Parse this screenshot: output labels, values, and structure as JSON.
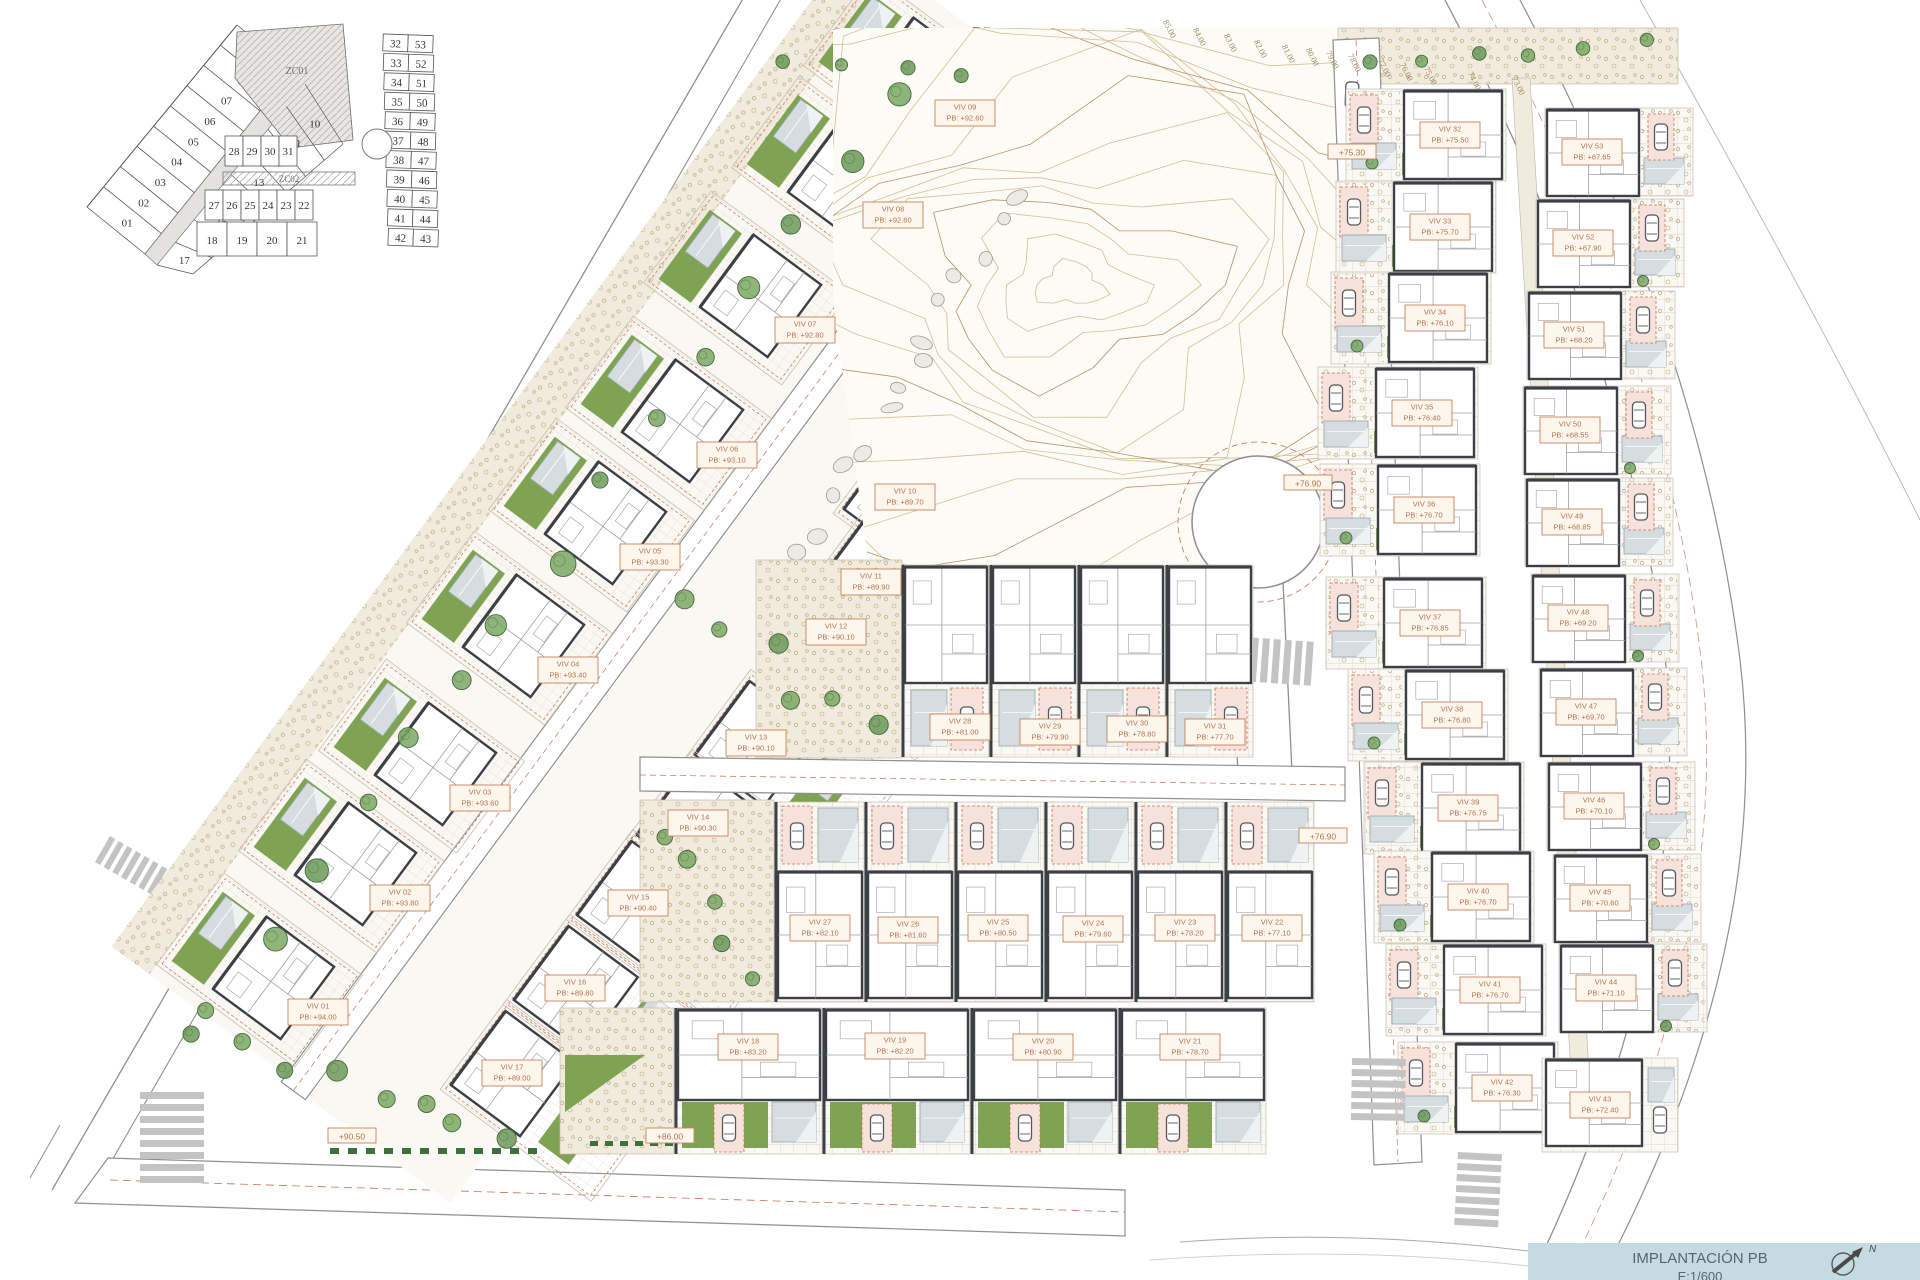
{
  "title_block": {
    "title": "IMPLANTACIÓN PB",
    "scale": "E:1/600",
    "north_label": "N"
  },
  "key_plan": {
    "zones": [
      "ZC01",
      "ZC02"
    ],
    "outer_lots": [
      "01",
      "02",
      "03",
      "04",
      "05",
      "06",
      "07",
      "08",
      "09"
    ],
    "inner_lots": [
      "10",
      "11",
      "12",
      "13",
      "14",
      "15",
      "16",
      "17"
    ],
    "row_a": [
      "28",
      "29",
      "30",
      "31"
    ],
    "row_b": [
      "27",
      "26",
      "25",
      "24",
      "23",
      "22"
    ],
    "row_c": [
      "18",
      "19",
      "20",
      "21"
    ],
    "right_block_left": [
      "32",
      "33",
      "34",
      "35",
      "36",
      "37",
      "38",
      "39",
      "40",
      "41",
      "42"
    ],
    "right_block_right": [
      "53",
      "52",
      "51",
      "50",
      "49",
      "48",
      "47",
      "46",
      "45",
      "44",
      "43"
    ]
  },
  "contour_labels": [
    {
      "text": "85.00",
      "x": 1167,
      "y": 30
    },
    {
      "text": "84.00",
      "x": 1197,
      "y": 38
    },
    {
      "text": "83.00",
      "x": 1228,
      "y": 44
    },
    {
      "text": "82.00",
      "x": 1258,
      "y": 50
    },
    {
      "text": "81.00",
      "x": 1286,
      "y": 55
    },
    {
      "text": "80.00",
      "x": 1310,
      "y": 58
    },
    {
      "text": "79.00",
      "x": 1330,
      "y": 61
    },
    {
      "text": "78.00",
      "x": 1352,
      "y": 64
    },
    {
      "text": "77.00",
      "x": 1382,
      "y": 69
    },
    {
      "text": "76.00",
      "x": 1404,
      "y": 73
    },
    {
      "text": "75.00",
      "x": 1428,
      "y": 77
    },
    {
      "text": "74.00",
      "x": 1472,
      "y": 82
    },
    {
      "text": "73.00",
      "x": 1516,
      "y": 87
    }
  ],
  "road_levels": [
    {
      "text": "+75.30",
      "x": 1352,
      "y": 152
    },
    {
      "text": "+76.90",
      "x": 1308,
      "y": 483
    },
    {
      "text": "+76.90",
      "x": 1323,
      "y": 836
    },
    {
      "text": "+86.00",
      "x": 670,
      "y": 1136
    },
    {
      "text": "+90.50",
      "x": 352,
      "y": 1136
    }
  ],
  "villas": [
    {
      "id": "VIV 01",
      "pb": "PB: +94.00",
      "x": 318,
      "y": 1012,
      "band": "outer",
      "i": 0
    },
    {
      "id": "VIV 02",
      "pb": "PB: +93.80",
      "x": 400,
      "y": 898,
      "band": "outer",
      "i": 1
    },
    {
      "id": "VIV 03",
      "pb": "PB: +93.60",
      "x": 480,
      "y": 798,
      "band": "outer",
      "i": 2
    },
    {
      "id": "VIV 04",
      "pb": "PB: +93.40",
      "x": 568,
      "y": 670,
      "band": "outer",
      "i": 3
    },
    {
      "id": "VIV 05",
      "pb": "PB: +93.30",
      "x": 650,
      "y": 557,
      "band": "outer",
      "i": 4
    },
    {
      "id": "VIV 06",
      "pb": "PB: +93.10",
      "x": 727,
      "y": 455,
      "band": "outer",
      "i": 5
    },
    {
      "id": "VIV 07",
      "pb": "PB: +92.80",
      "x": 805,
      "y": 330,
      "band": "outer",
      "i": 6
    },
    {
      "id": "VIV 08",
      "pb": "PB: +92.60",
      "x": 893,
      "y": 215,
      "band": "outer",
      "i": 7
    },
    {
      "id": "VIV 09",
      "pb": "PB: +92.60",
      "x": 965,
      "y": 113,
      "band": "outer",
      "i": 8
    },
    {
      "id": "VIV 10",
      "pb": "PB: +89.70",
      "x": 905,
      "y": 497,
      "band": "inner",
      "i": 0
    },
    {
      "id": "VIV 11",
      "pb": "PB: +89.90",
      "x": 871,
      "y": 582,
      "band": "inner",
      "i": 1
    },
    {
      "id": "VIV 12",
      "pb": "PB: +90.10",
      "x": 836,
      "y": 632,
      "band": "inner",
      "i": 2
    },
    {
      "id": "VIV 13",
      "pb": "PB: +90.10",
      "x": 756,
      "y": 743,
      "band": "inner",
      "i": 3
    },
    {
      "id": "VIV 14",
      "pb": "PB: +90.30",
      "x": 698,
      "y": 823,
      "band": "inner",
      "i": 4
    },
    {
      "id": "VIV 15",
      "pb": "PB: +90.40",
      "x": 638,
      "y": 903,
      "band": "inner",
      "i": 5
    },
    {
      "id": "VIV 16",
      "pb": "PB: +89.80",
      "x": 575,
      "y": 988,
      "band": "inner",
      "i": 6
    },
    {
      "id": "VIV 17",
      "pb": "PB: +89.00",
      "x": 512,
      "y": 1073,
      "band": "inner",
      "i": 7
    },
    {
      "id": "VIV 18",
      "pb": "PB: +83.20",
      "x": 748,
      "y": 1047,
      "band": "rowBig",
      "i": 0
    },
    {
      "id": "VIV 19",
      "pb": "PB: +82.20",
      "x": 895,
      "y": 1046,
      "band": "rowBig",
      "i": 1
    },
    {
      "id": "VIV 20",
      "pb": "PB: +80.90",
      "x": 1043,
      "y": 1047,
      "band": "rowBig",
      "i": 2
    },
    {
      "id": "VIV 21",
      "pb": "PB: +78.70",
      "x": 1190,
      "y": 1047,
      "band": "rowBig",
      "i": 3
    },
    {
      "id": "VIV 22",
      "pb": "PB: +77.10",
      "x": 1272,
      "y": 928,
      "band": "rowMid",
      "i": 5
    },
    {
      "id": "VIV 23",
      "pb": "PB: +78.20",
      "x": 1185,
      "y": 928,
      "band": "rowMid",
      "i": 4
    },
    {
      "id": "VIV 24",
      "pb": "PB: +79.60",
      "x": 1093,
      "y": 929,
      "band": "rowMid",
      "i": 3
    },
    {
      "id": "VIV 25",
      "pb": "PB: +80.50",
      "x": 998,
      "y": 928,
      "band": "rowMid",
      "i": 2
    },
    {
      "id": "VIV 26",
      "pb": "PB: +81.60",
      "x": 908,
      "y": 930,
      "band": "rowMid",
      "i": 1
    },
    {
      "id": "VIV 27",
      "pb": "PB: +82.10",
      "x": 820,
      "y": 928,
      "band": "rowMid",
      "i": 0
    },
    {
      "id": "VIV 28",
      "pb": "PB: +81.00",
      "x": 960,
      "y": 727,
      "band": "rowTop",
      "i": 0
    },
    {
      "id": "VIV 29",
      "pb": "PB: +79.90",
      "x": 1050,
      "y": 732,
      "band": "rowTop",
      "i": 1
    },
    {
      "id": "VIV 30",
      "pb": "PB: +78.80",
      "x": 1137,
      "y": 729,
      "band": "rowTop",
      "i": 2
    },
    {
      "id": "VIV 31",
      "pb": "PB: +77.70",
      "x": 1215,
      "y": 732,
      "band": "rowTop",
      "i": 3
    },
    {
      "id": "VIV 32",
      "pb": "PB: +75.50",
      "x": 1450,
      "y": 135,
      "band": "rcLeft",
      "i": 0
    },
    {
      "id": "VIV 33",
      "pb": "PB: +75.70",
      "x": 1440,
      "y": 227,
      "band": "rcLeft",
      "i": 1
    },
    {
      "id": "VIV 34",
      "pb": "PB: +76.10",
      "x": 1435,
      "y": 318,
      "band": "rcLeft",
      "i": 2
    },
    {
      "id": "VIV 35",
      "pb": "PB: +76.40",
      "x": 1422,
      "y": 413,
      "band": "rcLeft",
      "i": 3
    },
    {
      "id": "VIV 36",
      "pb": "PB: +76.70",
      "x": 1424,
      "y": 510,
      "band": "rcLeft",
      "i": 4
    },
    {
      "id": "VIV 37",
      "pb": "PB: +76.85",
      "x": 1430,
      "y": 623,
      "band": "rcLeft",
      "i": 5
    },
    {
      "id": "VIV 38",
      "pb": "PB: +76.80",
      "x": 1452,
      "y": 715,
      "band": "rcLeft",
      "i": 6
    },
    {
      "id": "VIV 39",
      "pb": "PB: +76.75",
      "x": 1468,
      "y": 808,
      "band": "rcLeft",
      "i": 7
    },
    {
      "id": "VIV 40",
      "pb": "PB: +76.70",
      "x": 1478,
      "y": 897,
      "band": "rcLeft",
      "i": 8
    },
    {
      "id": "VIV 41",
      "pb": "PB: +76.70",
      "x": 1490,
      "y": 990,
      "band": "rcLeft",
      "i": 9
    },
    {
      "id": "VIV 42",
      "pb": "PB: +76.30",
      "x": 1502,
      "y": 1088,
      "band": "rcLeft",
      "i": 10
    },
    {
      "id": "VIV 43",
      "pb": "PB: +72.40",
      "x": 1600,
      "y": 1105,
      "band": "rcBottom",
      "i": 0
    },
    {
      "id": "VIV 44",
      "pb": "PB: +71.10",
      "x": 1606,
      "y": 988,
      "band": "rcRight",
      "i": 9
    },
    {
      "id": "VIV 45",
      "pb": "PB: +70.60",
      "x": 1600,
      "y": 898,
      "band": "rcRight",
      "i": 8
    },
    {
      "id": "VIV 46",
      "pb": "PB: +70.10",
      "x": 1594,
      "y": 806,
      "band": "rcRight",
      "i": 7
    },
    {
      "id": "VIV 47",
      "pb": "PB: +69.70",
      "x": 1586,
      "y": 712,
      "band": "rcRight",
      "i": 6
    },
    {
      "id": "VIV 48",
      "pb": "PB: +69.20",
      "x": 1578,
      "y": 618,
      "band": "rcRight",
      "i": 5
    },
    {
      "id": "VIV 49",
      "pb": "PB: +68.85",
      "x": 1572,
      "y": 522,
      "band": "rcRight",
      "i": 4
    },
    {
      "id": "VIV 50",
      "pb": "PB: +68.55",
      "x": 1570,
      "y": 430,
      "band": "rcRight",
      "i": 3
    },
    {
      "id": "VIV 51",
      "pb": "PB: +68.20",
      "x": 1574,
      "y": 335,
      "band": "rcRight",
      "i": 2
    },
    {
      "id": "VIV 52",
      "pb": "PB: +67.90",
      "x": 1583,
      "y": 243,
      "band": "rcRight",
      "i": 1
    },
    {
      "id": "VIV 53",
      "pb": "PB: +67.65",
      "x": 1592,
      "y": 152,
      "band": "rcRight",
      "i": 0
    }
  ],
  "colors": {
    "lawn": "#7fa352",
    "pool": "#d6dde0",
    "wall": "#3c4046",
    "label_text": "#b5714f",
    "label_border": "#c8825a",
    "label_bg": "#fdf6ec",
    "road_line": "#8f8f8f",
    "red_dash": "#c6705b",
    "contour": "#d3bd97",
    "contour_major": "#b98f6a",
    "tree": "#5f8f52",
    "title_bg": "#c5dbe2",
    "gravel_bg": "#f1ebdd",
    "plot_bg": "#faf8f3"
  }
}
